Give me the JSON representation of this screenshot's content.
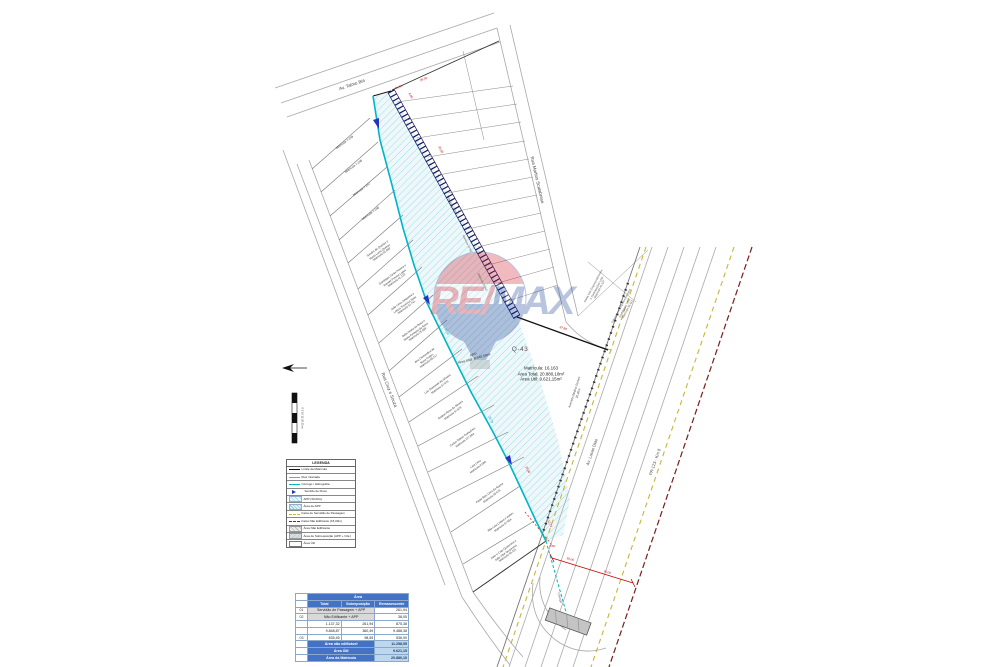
{
  "title_block": {
    "q43": "Q-43",
    "center": "Matrícula: 16.163\nÁrea Total: 20.880,10m²\nÁrea Útil: 9.621,15m²",
    "app": "APP\nÁrea total: 8.649,58m²"
  },
  "streets": {
    "top": "Av. Talmo Bia",
    "right": "Rua Martins Scalabrese",
    "left": "Rua Cruz e Souza",
    "avenue_service": "Avenida Galdino Gomes\n20,00m",
    "avenue_main": "Av. Lucas Dias",
    "highway": "PR-123 - Km 8"
  },
  "culvert_label": "Córrego",
  "scalebar_label": "0   5   10   15   20   25 m",
  "dims": {
    "d1": "50,00",
    "d2": "29,09",
    "d3": "35,00",
    "d4": "37,80",
    "d5": "30,00",
    "d6": "70,00",
    "d7": "12,73",
    "d8": "3,00",
    "d9": "36,56",
    "d10": "28,78",
    "d11": "8,00",
    "d12": "15,00"
  },
  "lots": [
    "Matrícula 7.249",
    "Matrícula 7.248",
    "Matrícula 7.247",
    "Matrícula 7.246",
    "Sandra de Queiroz e\nMaria Luiza Queiroz\nMatrícula 51.949",
    "Domingos Costa Pereira e\nManoel Pereira Lopes\nMatrícula 41.123",
    "João Lima Junqueira e\nLetícia Travessa Maia\nMatrícula 32.741",
    "Sofia Maria da Rosa e\nMaria Fontana da Rosa\nMatrícula 25.098",
    "Ana Clementina de\nRosa Prates\nMatrícula 89.217",
    "Luiz Diamante da Silveira\nMatrícula 97.878",
    "Raquel Rosa da Silveira\nMatrícula 97.879",
    "Carlos Tobias Gonçalves\nMatrícula 127.984",
    "Lara Lima\nMatrícula 9.099",
    "Fábio Reis Lima da Rocha\nMatrícula 45.678",
    "Rita Laia Lisboa e outros\nMatrícula 87.654",
    "Jane e Caio Quaresma e\nJoão Vitor Quaresma\nMatrícula 64.321"
  ],
  "mini_lots": [
    "Matrícula 10.551",
    "Matrícula 10.552",
    "Matrícula 10.553"
  ],
  "right_blocks": [
    "Santa Inês Empreendimentos\ne Participações Ltda.\nMatrícula 41.537",
    "Sobremonte Empreendimentos\nImobiliários Ltda.\nMatrícula 38.112"
  ],
  "legend": {
    "title": "LEGENDA",
    "items": [
      {
        "label": "Limite da Matrícula"
      },
      {
        "label": "Rua / Estrada"
      },
      {
        "label": "Córrego / Hidrografia"
      },
      {
        "label": "Sentido de Fluxo"
      },
      {
        "label": "APP (30,00m)"
      },
      {
        "label": "Área de APP"
      },
      {
        "label": "Faixa de Servidão de Passagem"
      },
      {
        "label": "Faixa Não Edificante (15,00m)"
      },
      {
        "label": "Área Não Edificante"
      },
      {
        "label": "Área de Sobreposição (APP + N.E.)"
      },
      {
        "label": "Área Útil"
      }
    ]
  },
  "table": {
    "title": "Área",
    "columns": [
      "Total",
      "Sobreposição",
      "Remanescente"
    ],
    "rows": [
      {
        "id": "01",
        "a": "Servidão de Passagem + APP",
        "b": "",
        "c": "261,94"
      },
      {
        "id": "02",
        "a": "Não Edificante + APP",
        "b": "",
        "c": "38,05"
      },
      {
        "id": "",
        "a": "1.137,32",
        "b": "261,94",
        "c": "875,38"
      },
      {
        "id": "",
        "a": "9.848,87",
        "b": "360,49",
        "c": "9.488,38"
      },
      {
        "id": "03",
        "a": "635,45",
        "b": "98,55",
        "c": "536,90"
      }
    ],
    "summary": [
      {
        "label": "Área não edificável",
        "value": "11.258,95"
      },
      {
        "label": "Área Útil",
        "value": "9.621,15"
      },
      {
        "label": "Área da Matrícula",
        "value": "20.880,10"
      }
    ]
  },
  "watermark": {
    "re": "RE/",
    "max": "MAX"
  },
  "colors": {
    "stream": "#00b5c9",
    "app_hatch": "#9ddde5",
    "band": "#15155e",
    "dim_red": "#c40000",
    "yellow_dash": "#c8b637",
    "dark_red_dash": "#7a1c1c",
    "table_header": "#4472c4",
    "table_light": "#bdd7ee",
    "remax_red": "#d21f2c",
    "remax_blue": "#1b3f94"
  }
}
